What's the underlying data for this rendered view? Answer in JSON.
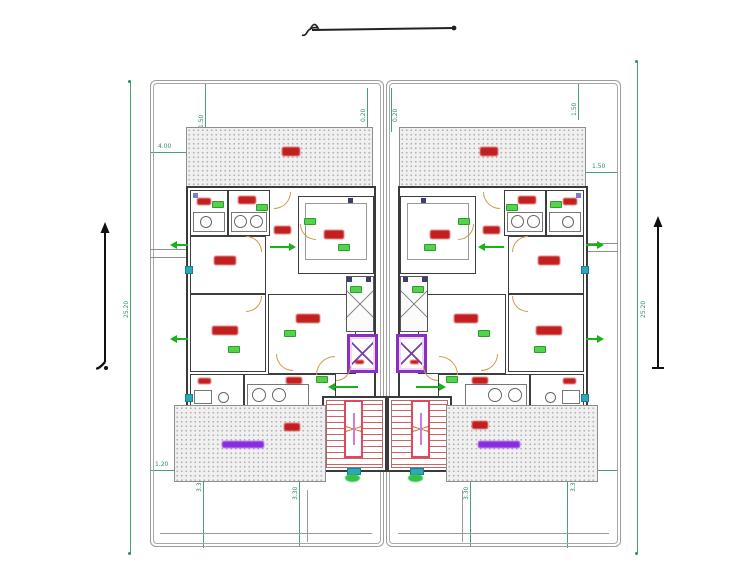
{
  "labels": {
    "bedroom": "غرفة نوم",
    "majlis": "مجلس رجال",
    "living": "صالة معيشة",
    "kitchen": "مطبخ",
    "bath": "حمام",
    "wc": "دورة مياه",
    "hall": "صالة",
    "terrace": "حوش",
    "parking": "موقف سيارات",
    "stair": "درج",
    "elevator": "مصعد",
    "shaft": "منور"
  },
  "dims": {
    "side_left": "25.20",
    "side_right": "25.20",
    "top_left_h": "4.00",
    "top_left_v": "1.50",
    "top_center_left": "0.20",
    "top_center_right": "0.20",
    "top_right_v": "1.50",
    "top_right_h": "1.50",
    "bottom_left_h": "1.20",
    "bottom_right_h": "1.20",
    "yard_left_a": "3.30",
    "yard_left_b": "3.30",
    "yard_right_a": "3.30",
    "yard_right_b": "3.30"
  },
  "colors": {
    "dimension_green": "#44a371",
    "wall": "#3a3a3a",
    "label_red": "#c41f1f",
    "door_orange": "#cf9a52",
    "elevator_purple": "#8b2fc0",
    "stair_accent": "#e0485f",
    "badge_green": "#55d24b",
    "marker_teal": "#2aa8bd",
    "parking_purple": "#8a2be2"
  }
}
